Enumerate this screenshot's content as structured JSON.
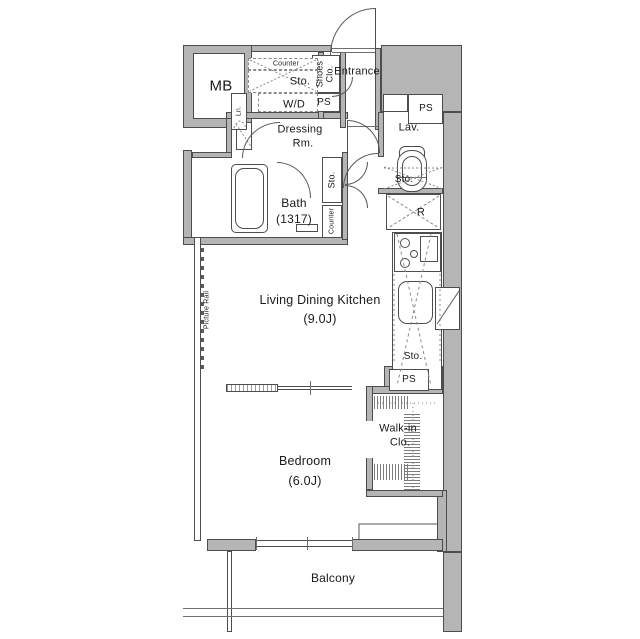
{
  "title": "1K apartment floor plan",
  "colors": {
    "background": "#ffffff",
    "wall_fill": "#b5b5b5",
    "line": "#4d4d4d",
    "dashed_line": "#8a8a8a",
    "text": "#1a1a1a"
  },
  "labels": {
    "mb": "MB",
    "counter_top": "Counter",
    "sto_top": "Sto.",
    "wd": "W/D",
    "ln": "Ln.",
    "shoes_line1": "Shoes",
    "shoes_line2": "Clo.",
    "entrance": "Entrance",
    "ps_entry": "PS",
    "ps_lav": "PS",
    "ps_kitchen": "PS",
    "dressing_line1": "Dressing",
    "dressing_line2": "Rm.",
    "lav": "Lav.",
    "sto_lav": "Sto.",
    "bath_line1": "Bath",
    "bath_line2": "(1317)",
    "sto_hall": "Sto.",
    "counter_hall": "Counter",
    "fridge": "R",
    "ldk_line1": "Living Dining Kitchen",
    "ldk_line2": "(9.0J)",
    "sto_kitchen": "Sto.",
    "picture_rail": "Picture Rail",
    "walkin_line1": "Walk-in",
    "walkin_line2": "Clo.",
    "bedroom_line1": "Bedroom",
    "bedroom_line2": "(6.0J)",
    "balcony": "Balcony"
  }
}
